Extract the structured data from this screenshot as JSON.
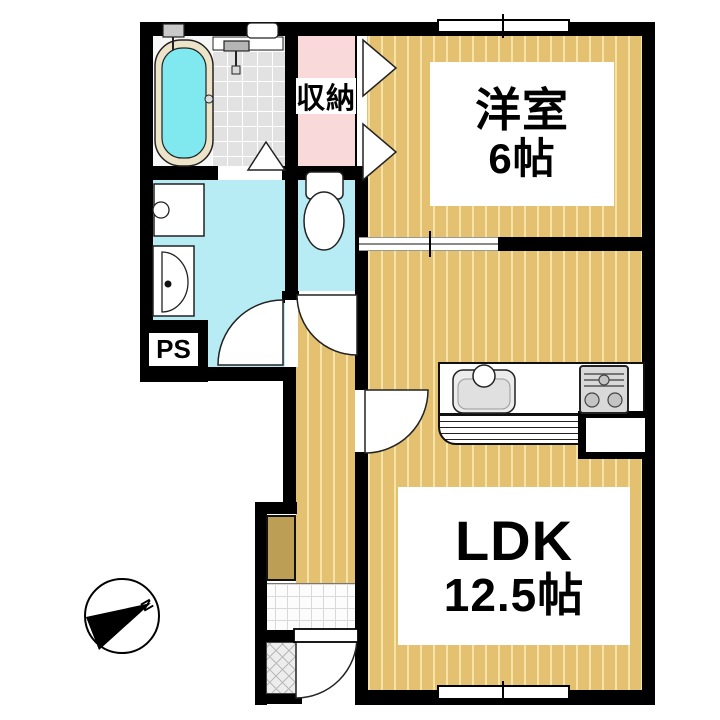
{
  "rooms": {
    "western": {
      "label": "洋室",
      "size": "6帖"
    },
    "ldk": {
      "label": "LDK",
      "size": "12.5帖"
    },
    "storage": {
      "label": "収納"
    },
    "pipe_space": {
      "label": "PS"
    }
  },
  "compass": {
    "north_label": "N"
  },
  "colors": {
    "floor": "#e4c170",
    "floor-stripe": "#f6e3a8",
    "wet": "#b7ecf4",
    "tub": "#7fe9ef",
    "tub-rim": "#ede3c8",
    "pink": "#f9d9d9",
    "tile": "#e2e2e2",
    "cabinet": "#bd9e55",
    "wall": "#000000"
  }
}
